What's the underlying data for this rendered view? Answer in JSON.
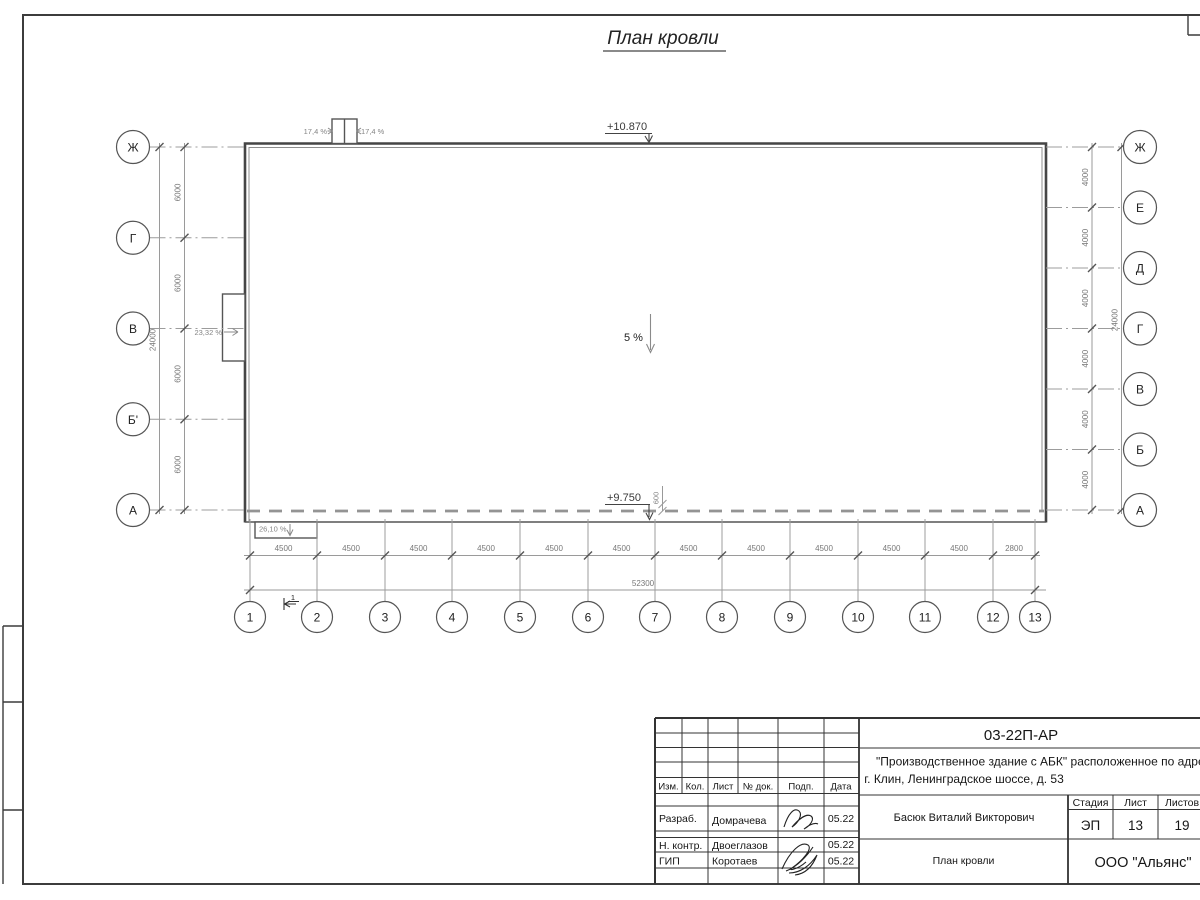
{
  "page": {
    "title": "План кровли"
  },
  "plan": {
    "elevation_top": "+10.870",
    "elevation_bottom": "+9.750",
    "slope_center": "5 %",
    "slope_shaft_left": "17,4 %",
    "slope_shaft_right": "17,4 %",
    "slope_left_canopy": "23,32 %",
    "slope_bottom_canopy": "26,10 %",
    "eaves_offset": "600",
    "section_mark": "1",
    "axes_left": [
      "Ж",
      "Г",
      "В",
      "Б'",
      "А"
    ],
    "axes_right": [
      "Ж",
      "Е",
      "Д",
      "Г",
      "В",
      "Б",
      "А"
    ],
    "axes_bottom": [
      "1",
      "2",
      "3",
      "4",
      "5",
      "6",
      "7",
      "8",
      "9",
      "10",
      "11",
      "12",
      "13"
    ],
    "dims_left": [
      "6000",
      "6000",
      "6000",
      "6000"
    ],
    "dim_left_total": "24000",
    "dims_right": [
      "4000",
      "4000",
      "4000",
      "4000",
      "4000",
      "4000"
    ],
    "dim_right_total": "24000",
    "dims_bottom": [
      "4500",
      "4500",
      "4500",
      "4500",
      "4500",
      "4500",
      "4500",
      "4500",
      "4500",
      "4500",
      "4500",
      "2800"
    ],
    "dim_bottom_total": "52300"
  },
  "titleblock": {
    "doc_number": "03-22П-АР",
    "project_line1": "\"Производственное здание с АБК\" расположенное по адресу:",
    "project_line2": "г. Клин, Ленинградское шоссе, д. 53",
    "header_cols": [
      "Изм.",
      "Кол.",
      "Лист",
      "№ док.",
      "Подп.",
      "Дата"
    ],
    "rows": [
      {
        "role": "Разраб.",
        "name": "Домрачева",
        "date": "05.22"
      },
      {
        "role": "Н. контр.",
        "name": "Двоеглазов",
        "date": "05.22"
      },
      {
        "role": "ГИП",
        "name": "Коротаев",
        "date": "05.22"
      }
    ],
    "approver": "Басюк Виталий Викторович",
    "stage_label": "Стадия",
    "sheet_label": "Лист",
    "sheets_label": "Листов",
    "stage": "ЭП",
    "sheet": "13",
    "sheets": "19",
    "drawing_title": "План кровли",
    "company": "ООО \"Альянс\""
  }
}
